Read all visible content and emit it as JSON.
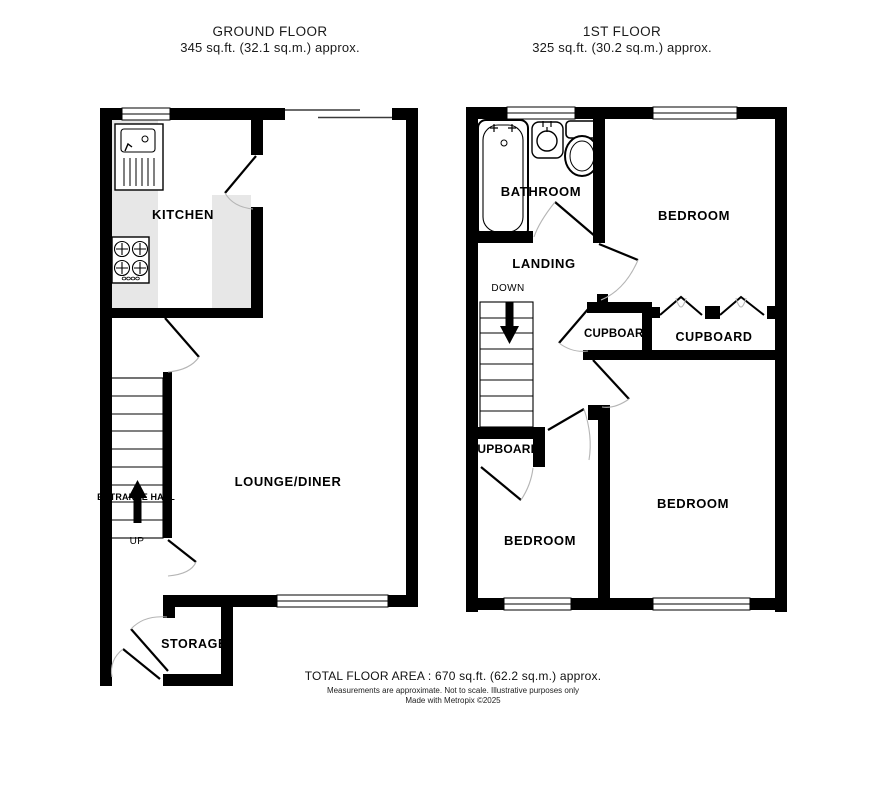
{
  "ground_floor": {
    "title": "GROUND FLOOR",
    "area": "345 sq.ft. (32.1 sq.m.) approx.",
    "rooms": {
      "kitchen": "KITCHEN",
      "lounge": "LOUNGE/DINER",
      "entrance_hall": "ENTRANCE HALL",
      "storage": "STORAGE"
    },
    "stairs_label": "UP"
  },
  "first_floor": {
    "title": "1ST FLOOR",
    "area": "325 sq.ft. (30.2 sq.m.) approx.",
    "rooms": {
      "bathroom": "BATHROOM",
      "landing": "LANDING",
      "bedroom": "BEDROOM",
      "cupboard": "CUPBOARD"
    },
    "stairs_label": "DOWN"
  },
  "footer": {
    "total": "TOTAL FLOOR AREA : 670 sq.ft. (62.2 sq.m.) approx.",
    "disclaimer": "Measurements are approximate.  Not to scale.  Illustrative purposes only",
    "credit": "Made with Metropix ©2025"
  },
  "colors": {
    "wall": "#000000",
    "counter": "#e7e7e7",
    "door_swing": "#b5b5b5"
  }
}
